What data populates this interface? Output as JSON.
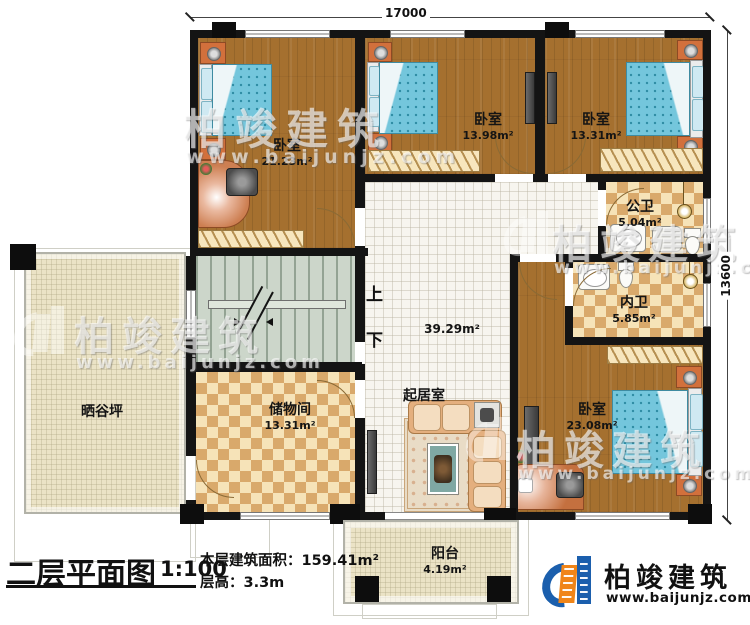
{
  "plan_title": {
    "title": "二层平面图",
    "scale": "1:100",
    "floor_area_label": "本层建筑面积：",
    "floor_area_value": "159.41m²",
    "floor_height_label": "层高：",
    "floor_height_value": "3.3m"
  },
  "dimensions": {
    "top_width": "17000",
    "right_height": "13600"
  },
  "rooms": {
    "bedroom_top_left": {
      "name": "卧室",
      "area": "21.23m²"
    },
    "bedroom_top_mid": {
      "name": "卧室",
      "area": "13.98m²"
    },
    "bedroom_top_right": {
      "name": "卧室",
      "area": "13.31m²"
    },
    "bedroom_bottom_right": {
      "name": "卧室",
      "area": "23.08m²"
    },
    "public_bath": {
      "name": "公卫",
      "area": "5.04m²"
    },
    "private_bath": {
      "name": "内卫",
      "area": "5.85m²"
    },
    "living_room": {
      "name": "起居室",
      "area": "39.29m²"
    },
    "storage": {
      "name": "储物间",
      "area": "13.31m²"
    },
    "terrace": {
      "name": "晒谷坪"
    },
    "balcony": {
      "name": "阳台",
      "area": "4.19m²"
    }
  },
  "stairs": {
    "up": "上",
    "down": "下"
  },
  "branding": {
    "company": "柏竣建筑",
    "website": "www.baijunjz.com"
  },
  "watermark": {
    "company": "柏竣建筑",
    "website": "www.baijunjz.com"
  },
  "colors": {
    "wall": "#141414",
    "wood_floor": "#a5702f",
    "checker_tile": "#d9a96b",
    "living_tile": "#f7f5ef",
    "stairs": "#ccd6ca",
    "logo_blue": "#1b5fad",
    "logo_orange": "#f08519"
  }
}
